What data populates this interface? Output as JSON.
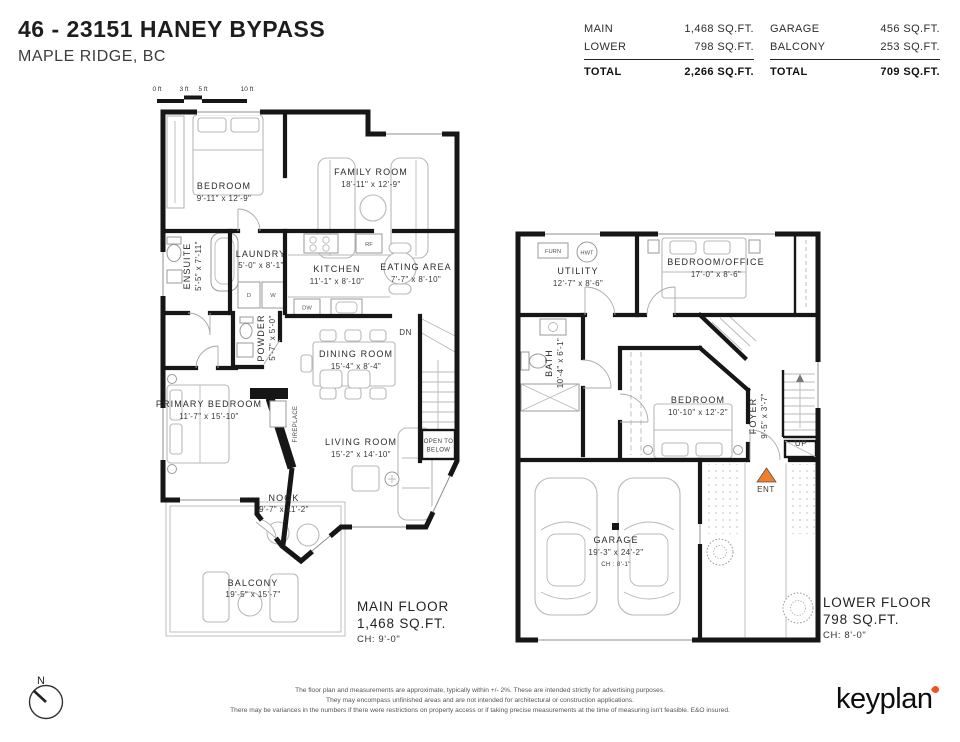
{
  "header": {
    "title": "46 - 23151 HANEY BYPASS",
    "subtitle": "MAPLE RIDGE, BC"
  },
  "area_table": {
    "interior": {
      "rows": [
        {
          "label": "MAIN",
          "value": "1,468 SQ.FT."
        },
        {
          "label": "LOWER",
          "value": "798 SQ.FT."
        }
      ],
      "total": {
        "label": "TOTAL",
        "value": "2,266 SQ.FT."
      }
    },
    "exterior": {
      "rows": [
        {
          "label": "GARAGE",
          "value": "456 SQ.FT."
        },
        {
          "label": "BALCONY",
          "value": "253 SQ.FT."
        }
      ],
      "total": {
        "label": "TOTAL",
        "value": "709 SQ.FT."
      }
    }
  },
  "scale_bar": {
    "ticks": [
      "0 ft",
      "3 ft",
      "5 ft",
      "10 ft"
    ]
  },
  "main_floor": {
    "rooms": [
      {
        "name": "BEDROOM",
        "dims": "9'-11\" x 12'-9\""
      },
      {
        "name": "FAMILY ROOM",
        "dims": "18'-11\" x 12'-9\""
      },
      {
        "name": "ENSUITE",
        "dims": "5'-5\" x 7'-11\""
      },
      {
        "name": "LAUNDRY",
        "dims": "5'-0\" x 8'-1\""
      },
      {
        "name": "KITCHEN",
        "dims": "11'-1\" x 8'-10\""
      },
      {
        "name": "EATING AREA",
        "dims": "7'-7\" x 8'-10\""
      },
      {
        "name": "POWDER",
        "dims": "5'-7\" x 5'-0\""
      },
      {
        "name": "DINING ROOM",
        "dims": "15'-4\" x 8'-4\""
      },
      {
        "name": "PRIMARY BEDROOM",
        "dims": "11'-7\" x 15'-10\""
      },
      {
        "name": "LIVING ROOM",
        "dims": "15'-2\" x 14'-10\""
      },
      {
        "name": "NOOK",
        "dims": "9'-7\" x 11'-2\""
      },
      {
        "name": "BALCONY",
        "dims": "19'-5\" x 15'-7\""
      }
    ],
    "annotations": {
      "fireplace": "FIREPLACE",
      "dn": "DN",
      "open_to_below_1": "OPEN TO",
      "open_to_below_2": "BELOW"
    },
    "summary": {
      "name": "MAIN FLOOR",
      "area": "1,468 SQ.FT.",
      "ch": "CH: 9'-0\""
    }
  },
  "lower_floor": {
    "rooms": [
      {
        "name": "UTILITY",
        "dims": "12'-7\" x 8'-6\""
      },
      {
        "name": "BEDROOM/OFFICE",
        "dims": "17'-0\" x 8'-6\""
      },
      {
        "name": "BATH",
        "dims": "10'-4\" x 6'-1\""
      },
      {
        "name": "BEDROOM",
        "dims": "10'-10\" x 12'-2\""
      },
      {
        "name": "FOYER",
        "dims": "9'-5\" x 3'-7\""
      },
      {
        "name": "GARAGE",
        "dims": "19'-3\" x 24'-2\"",
        "ch": "CH : 8'-1\""
      }
    ],
    "annotations": {
      "furn": "FURN",
      "hwt": "HWT",
      "up": "UP",
      "ent": "ENT"
    },
    "summary": {
      "name": "LOWER FLOOR",
      "area": "798 SQ.FT.",
      "ch": "CH: 8'-0\""
    }
  },
  "appliances": {
    "rf": "RF",
    "dw": "DW",
    "d": "D",
    "w": "W"
  },
  "compass": {
    "label": "N"
  },
  "footer": {
    "disclaimer": [
      "The floor plan and measurements are approximate, typically within +/- 2%. These are intended strictly for advertising purposes.",
      "They may encompass unfinished areas and are not intended for architectural or construction applications.",
      "There may be variances in the numbers if there were restrictions on property access or if taking precise measurements at the time of measuring isn't feasible. E&O insured."
    ],
    "logo": "keyplan"
  },
  "icons": {
    "logo_accent": "heart-mark",
    "entry_marker": "orange-triangle"
  },
  "colors": {
    "wall": "#161616",
    "furniture": "#b8b8b8",
    "accent_orange": "#ee7f2d"
  }
}
